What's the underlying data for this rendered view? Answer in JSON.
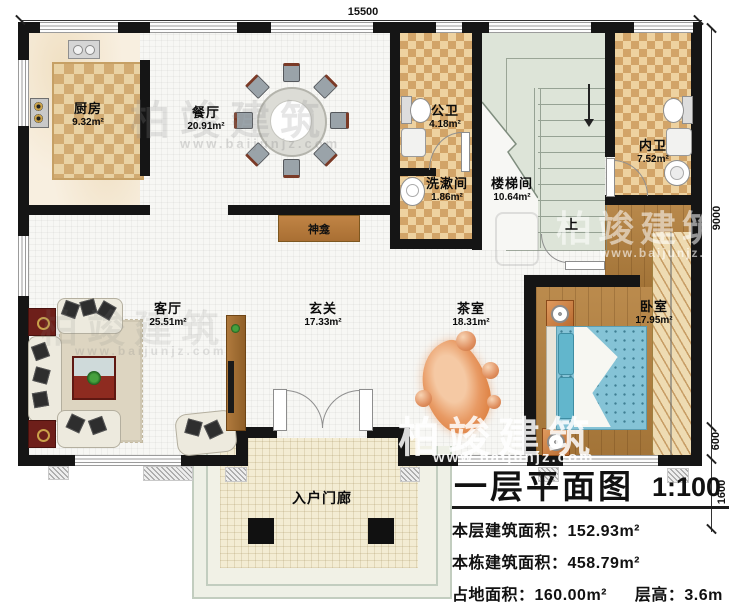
{
  "dimensions": {
    "top": "15500",
    "right_main": "9000",
    "right_step": "600",
    "right_porch": "1600"
  },
  "rooms": [
    {
      "name": "厨房",
      "area": "9.32m²"
    },
    {
      "name": "餐厅",
      "area": "20.91m²"
    },
    {
      "name": "公卫",
      "area": "4.18m²"
    },
    {
      "name": "洗漱间",
      "area": "1.86m²"
    },
    {
      "name": "楼梯间",
      "area": "10.64m²"
    },
    {
      "name": "内卫",
      "area": "7.52m²"
    },
    {
      "name": "客厅",
      "area": "25.51m²"
    },
    {
      "name": "玄关",
      "area": "17.33m²"
    },
    {
      "name": "茶室",
      "area": "18.31m²"
    },
    {
      "name": "卧室",
      "area": "17.95m²"
    },
    {
      "name": "入户门廊",
      "area": ""
    }
  ],
  "labels": {
    "shrine": "神龛",
    "up": "上"
  },
  "title_block": {
    "title": "一层平面图",
    "scale": "1:100",
    "line1": "本层建筑面积：152.93m²",
    "line2": "本栋建筑面积：458.79m²",
    "line3a": "占地面积：160.00m²",
    "line3b": "层高：3.6m"
  },
  "watermark": {
    "brand": "柏竣建筑",
    "url": "www.baijunjz.com"
  },
  "colors": {
    "wall": "#151515",
    "wood_floor": "#b5813e",
    "tile_checker": "#d2a468",
    "stair": "#dde4d8",
    "bed": "#85c3d6",
    "accent_orange": "#e09060"
  }
}
